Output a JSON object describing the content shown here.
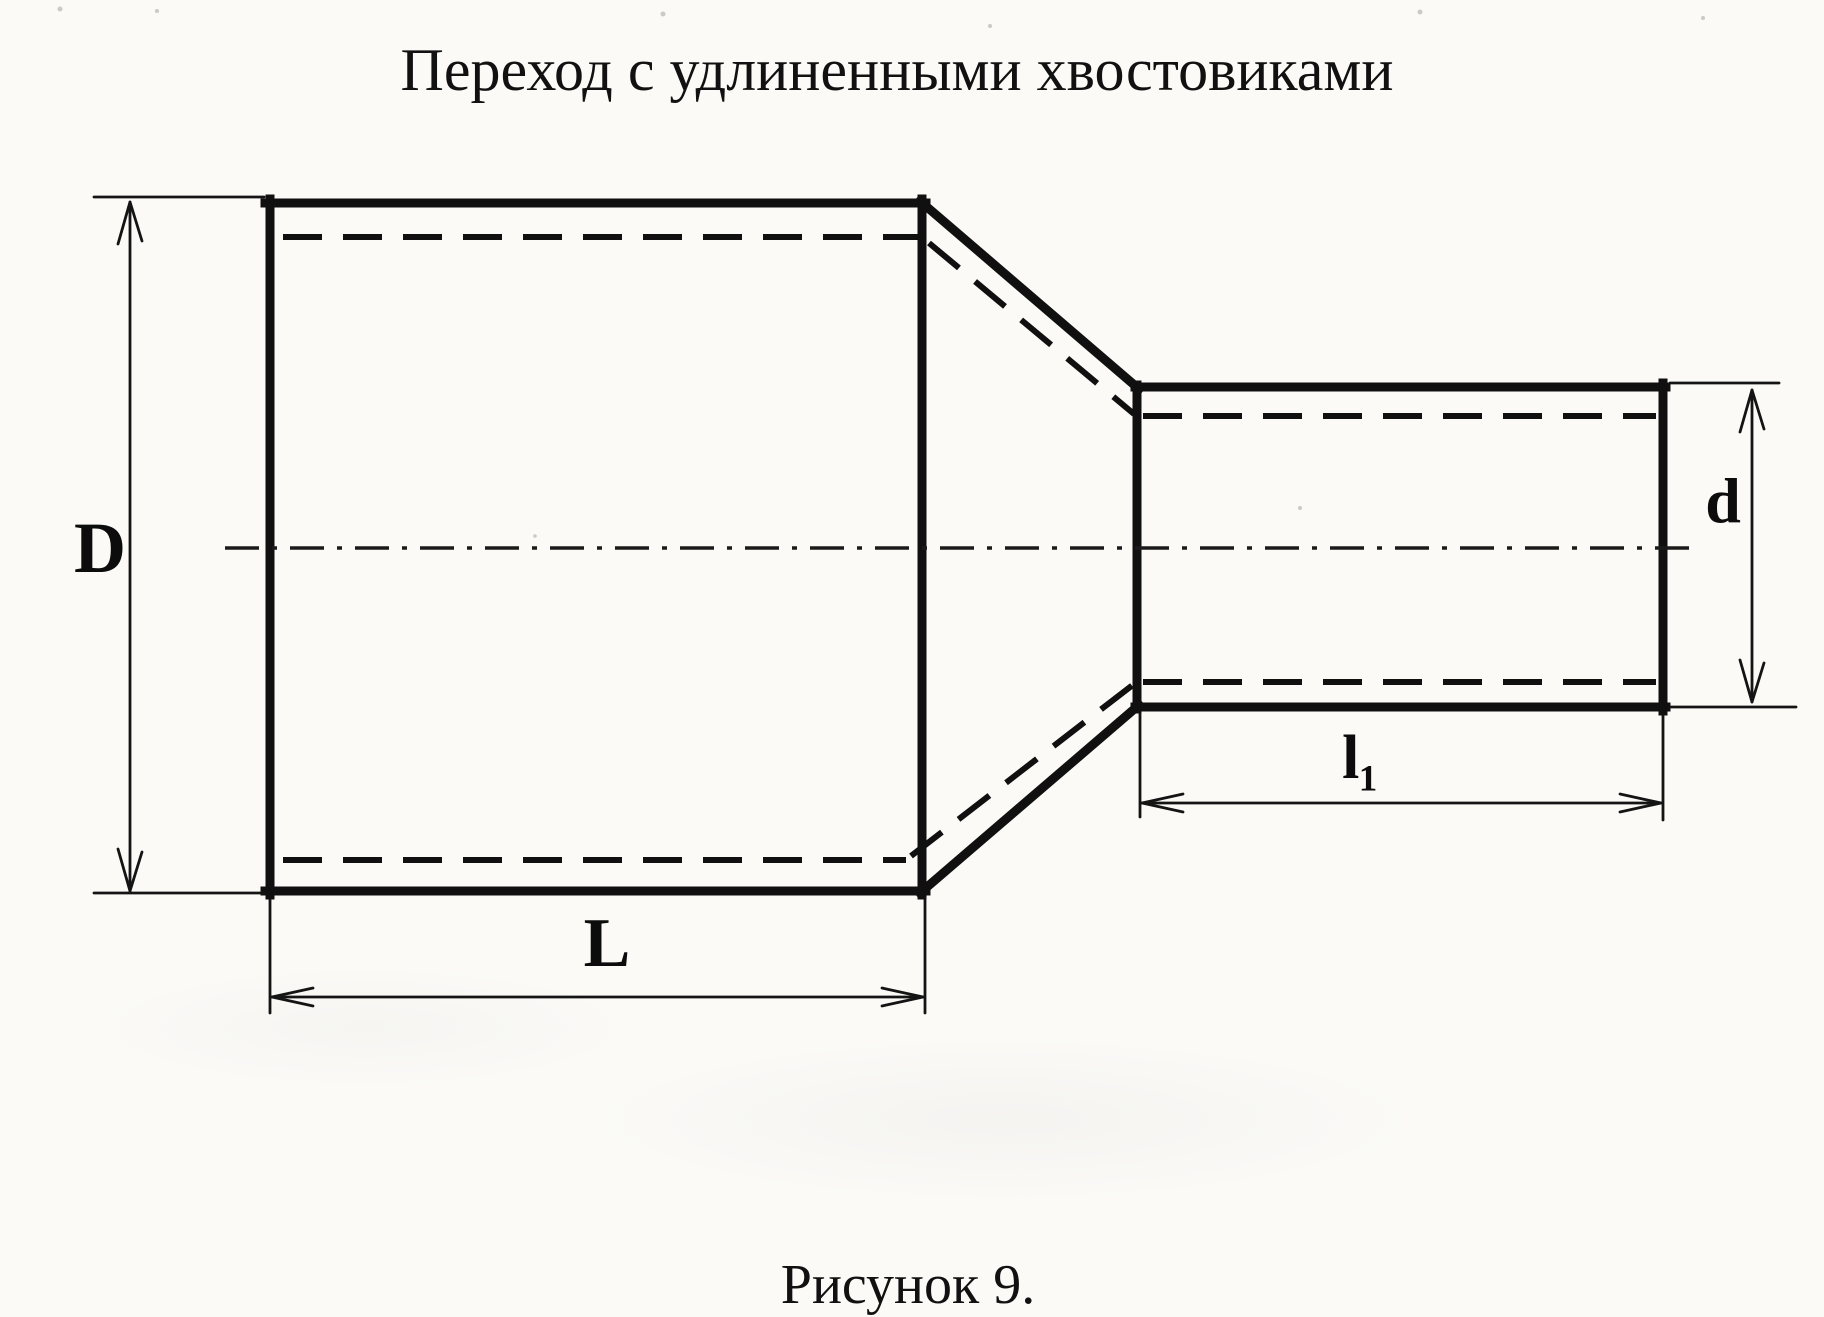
{
  "title": "Переход с удлиненными хвостовиками",
  "caption": "Рисунок 9.",
  "dimensions": {
    "diameter_large": "D",
    "diameter_small": "d",
    "length_large": "L",
    "length_small": "l₁"
  },
  "colors": {
    "ink": "#101010",
    "paper": "#fbfaf7"
  }
}
